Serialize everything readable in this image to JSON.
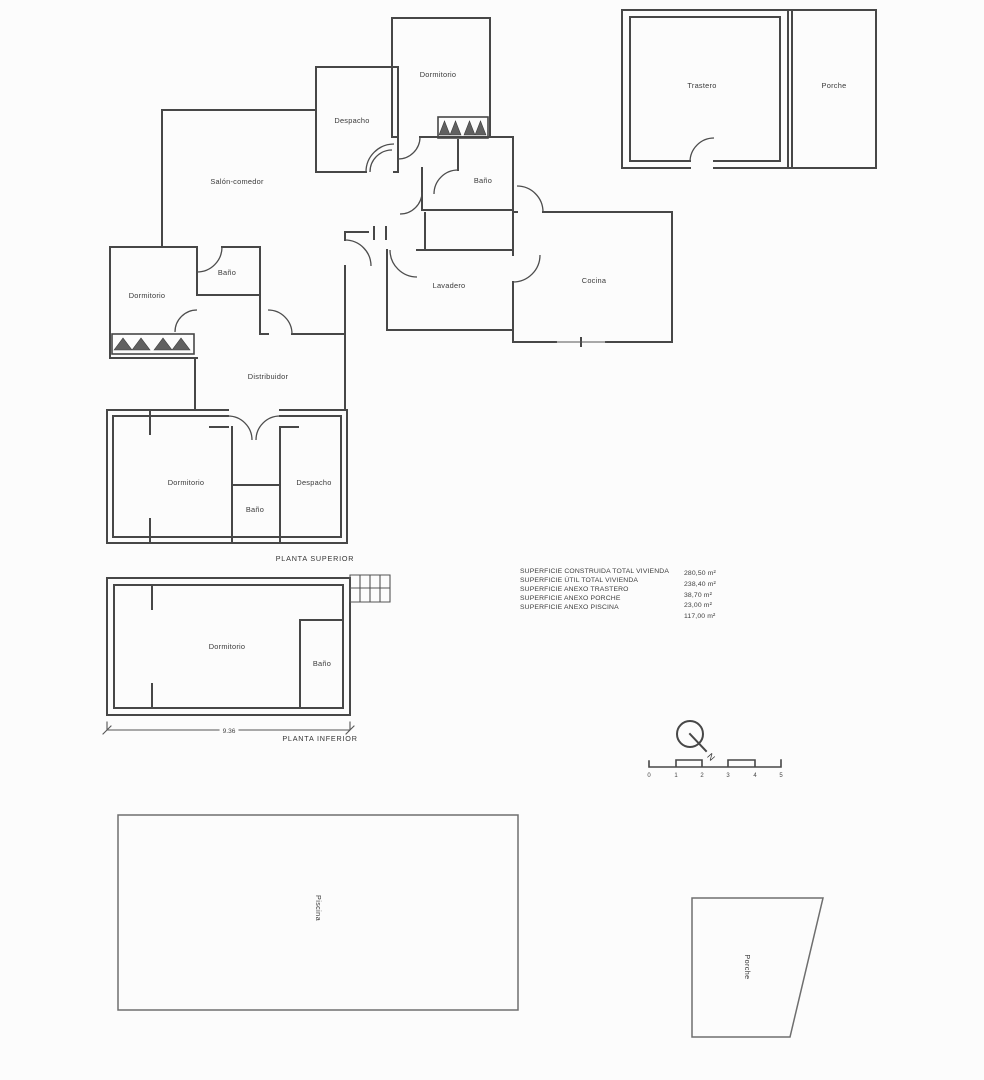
{
  "colors": {
    "background": "#fcfcfc",
    "line": "#474747",
    "light_line": "#6e6e6e",
    "text": "#3a3a3a"
  },
  "upper_floor": {
    "caption": "PLANTA SUPERIOR",
    "rooms": {
      "salon": "Salón-comedor",
      "despacho_top": "Despacho",
      "dormitorio_top": "Dormitorio",
      "bano_top": "Baño",
      "cocina": "Cocina",
      "lavadero": "Lavadero",
      "dormitorio_left": "Dormitorio",
      "bano_left": "Baño",
      "distribuidor": "Distribuidor",
      "dormitorio_bottom": "Dormitorio",
      "bano_bottom": "Baño",
      "despacho_bottom": "Despacho"
    }
  },
  "lower_floor": {
    "caption": "PLANTA INFERIOR",
    "rooms": {
      "dormitorio": "Dormitorio",
      "bano": "Baño"
    },
    "dimension": "9.36"
  },
  "annex": {
    "trastero": "Trastero",
    "porche": "Porche"
  },
  "outdoor": {
    "piscina": "Piscina",
    "porche": "Porche"
  },
  "areas_table": {
    "rows": [
      {
        "label": "SUPERFICIE CONSTRUIDA TOTAL VIVIENDA",
        "value": "280,50 m²"
      },
      {
        "label": "SUPERFICIE ÚTIL TOTAL VIVIENDA",
        "value": "238,40 m²"
      },
      {
        "label": "SUPERFICIE ANEXO TRASTERO",
        "value": "38,70 m²"
      },
      {
        "label": "SUPERFICIE ANEXO PORCHE",
        "value": "23,00 m²"
      },
      {
        "label": "SUPERFICIE ANEXO PISCINA",
        "value": "117,00 m²"
      }
    ]
  },
  "compass": {
    "north_label": "N"
  },
  "scale_bar": {
    "ticks": [
      "0",
      "1",
      "2",
      "3",
      "4",
      "5"
    ]
  }
}
